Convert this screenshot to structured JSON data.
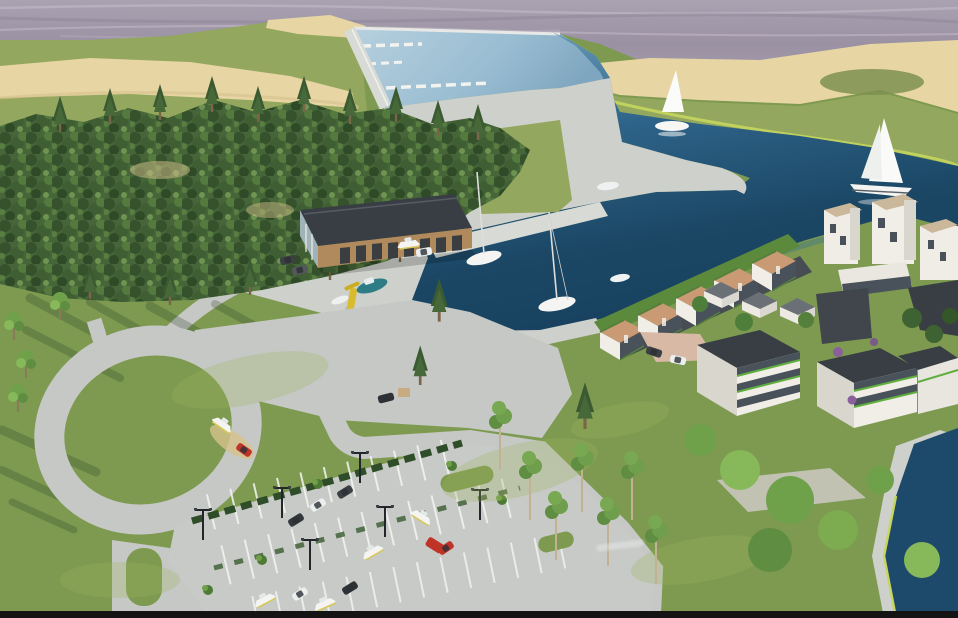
{
  "image": {
    "kind": "3d-architectural-rendering",
    "subject": "aerial view of a marina and waterfront housing development",
    "width_px": 958,
    "height_px": 618
  },
  "colors": {
    "sea_base": "#a29aa9",
    "sea_streak": "#c7c0cb",
    "sea_dark": "#8b8496",
    "marina_basin_light": "#aac8d8",
    "marina_basin_mid": "#7fa6c0",
    "channel_top": "#5e93b2",
    "water_deep": "#1c4866",
    "canal_water": "#1d4a6b",
    "sand": "#e7d5a4",
    "sand_shadow": "#d6c28c",
    "grass_hill": "#93a75e",
    "grass_field": "#7d9a50",
    "grass_light": "#9db45f",
    "shore_fringe": "#c6d65e",
    "forest_base": "#46663a",
    "pine_dark": "#3b5a31",
    "concrete": "#cdd0cb",
    "concrete_light": "#d7dad5",
    "road": "#c5c8c4",
    "parking": "#c7cac6",
    "stripe": "#f4f5f2",
    "hedge": "#2e4d28",
    "tree_light": "#8fc061",
    "tree_mid": "#5f8d42",
    "trunk": "#c2b193",
    "roof_dark": "#383e44",
    "roof_slate": "#6a7076",
    "wall_white": "#f0eee7",
    "wall_shade": "#d8d6cd",
    "wood": "#b08a5c",
    "terrace_roof": "#c99a74",
    "glass": "#49525a",
    "green_roof": "#55803c",
    "planter_green": "#5fae3e",
    "boat_white": "#f4f5f2",
    "hull_teal": "#2e7d86",
    "crane_yellow": "#d9bc2e",
    "truck_red": "#c03428",
    "car_dark": "#3c4043",
    "salmon_path": "#d8b9a6",
    "purple_plant": "#8a5f9a",
    "letterbox": "#141414"
  },
  "scene": {
    "water_features": {
      "open_sea": true,
      "marina_basin_with_pontoons": true,
      "entrance_channel": true,
      "inner_harbour": true,
      "canal_pond": true
    },
    "vessels": {
      "sailing_yachts": 2,
      "moored_sailboats": 2,
      "moored_motorboats": 3,
      "dinghies": 2,
      "boats_on_trailers": 4
    },
    "buildings": {
      "marina_boathouse": 1,
      "terraced_waterfront_units": 5,
      "white_towers": 3,
      "roof_pavilions": 3,
      "apartment_blocks": 5
    },
    "vehicles": {
      "cars": 8,
      "vans": 1,
      "red_pickups": 2
    },
    "landscape": {
      "pine_forest": true,
      "sand_dunes": true,
      "parking_rows": 3,
      "street_lamps": 6
    },
    "watermark": {
      "visible": true,
      "legible": false
    }
  }
}
